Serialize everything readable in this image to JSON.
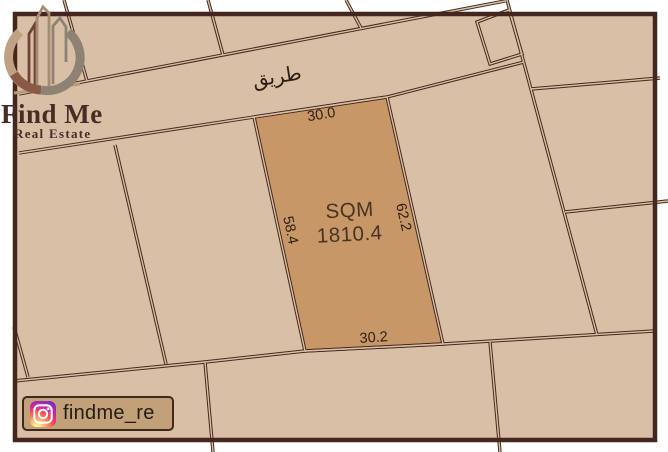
{
  "brand": {
    "name": "Find Me",
    "tagline": "Real Estate"
  },
  "social": {
    "handle": "findme_re",
    "icon": "instagram-icon"
  },
  "map": {
    "road_label": "طريق",
    "plot": {
      "area_label": "SQM",
      "area_value": "1810.4",
      "dim_top": "30.0",
      "dim_bottom": "30.2",
      "dim_left": "58.4",
      "dim_right": "62.2"
    }
  },
  "colors": {
    "frame": "#44261e",
    "map_bg": "#d9bfa6",
    "plot_fill": "#c79767",
    "boundary_line": "#45291d",
    "label_text": "#2e1d12",
    "brand_text": "#4b2b26",
    "badge_bg": "#c2a179"
  }
}
